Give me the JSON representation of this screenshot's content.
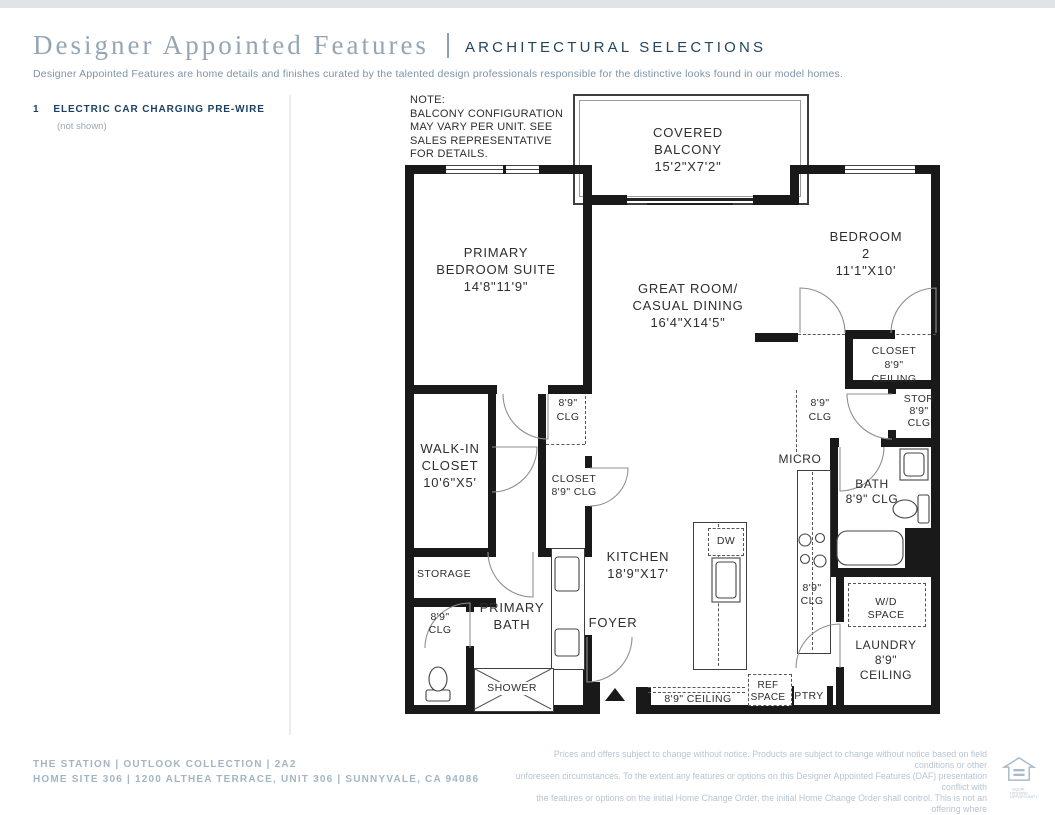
{
  "header": {
    "title": "Designer Appointed Features",
    "subtitle": "ARCHITECTURAL SELECTIONS",
    "description": "Designer Appointed Features are home details and finishes curated by the talented design professionals responsible for the distinctive looks found in our model homes."
  },
  "features": [
    {
      "num": "1",
      "label": "ELECTRIC CAR CHARGING PRE-WIRE",
      "note": "(not shown)"
    }
  ],
  "plan": {
    "note": [
      "NOTE:",
      "BALCONY CONFIGURATION",
      "MAY VARY PER UNIT. SEE",
      "SALES REPRESENTATIVE",
      "FOR DETAILS."
    ],
    "labels": [
      {
        "id": "covered-balcony",
        "lines": [
          "COVERED",
          "BALCONY",
          "15'2\"X7'2\""
        ]
      },
      {
        "id": "primary-bedroom-suite",
        "lines": [
          "PRIMARY",
          "BEDROOM SUITE",
          "14'8\"11'9\""
        ]
      },
      {
        "id": "great-room",
        "lines": [
          "GREAT ROOM/",
          "CASUAL DINING",
          "16'4\"X14'5\""
        ]
      },
      {
        "id": "bedroom-2",
        "lines": [
          "BEDROOM 2",
          "11'1\"X10'"
        ]
      },
      {
        "id": "bedroom2-closet",
        "lines": [
          "CLOSET",
          "8'9\" CEILING"
        ]
      },
      {
        "id": "hall2-clg",
        "lines": [
          "8'9\"",
          "CLG"
        ]
      },
      {
        "id": "stor",
        "lines": [
          "STOR",
          "8'9\"",
          "CLG"
        ]
      },
      {
        "id": "micro",
        "lines": [
          "MICRO"
        ]
      },
      {
        "id": "bath2",
        "lines": [
          "BATH",
          "8'9\" CLG"
        ]
      },
      {
        "id": "walk-in-closet",
        "lines": [
          "WALK-IN",
          "CLOSET",
          "10'6\"X5'"
        ]
      },
      {
        "id": "hall1-clg",
        "lines": [
          "8'9\"",
          "CLG"
        ]
      },
      {
        "id": "closet1",
        "lines": [
          "CLOSET",
          "8'9\" CLG"
        ]
      },
      {
        "id": "kitchen",
        "lines": [
          "KITCHEN",
          "18'9\"X17'"
        ]
      },
      {
        "id": "dw",
        "lines": [
          "DW"
        ]
      },
      {
        "id": "storage",
        "lines": [
          "STORAGE"
        ]
      },
      {
        "id": "primary-bath",
        "lines": [
          "PRIMARY",
          "BATH"
        ]
      },
      {
        "id": "toilet-clg",
        "lines": [
          "8'9\"",
          "CLG"
        ]
      },
      {
        "id": "foyer",
        "lines": [
          "FOYER"
        ]
      },
      {
        "id": "shower",
        "lines": [
          "SHOWER"
        ]
      },
      {
        "id": "range-clg",
        "lines": [
          "8'9\"",
          "CLG"
        ]
      },
      {
        "id": "wd-space",
        "lines": [
          "W/D SPACE"
        ]
      },
      {
        "id": "laundry",
        "lines": [
          "LAUNDRY",
          "8'9\" CEILING"
        ]
      },
      {
        "id": "kitchen-ceiling",
        "lines": [
          "8'9\" CEILING"
        ]
      },
      {
        "id": "ref-space",
        "lines": [
          "REF",
          "SPACE"
        ]
      },
      {
        "id": "ptry",
        "lines": [
          "PTRY"
        ]
      }
    ]
  },
  "footer": {
    "line1": "THE STATION | OUTLOOK COLLECTION | 2A2",
    "line2": "HOME SITE 306  |  1200 ALTHEA TERRACE, UNIT 306 | SUNNYVALE, CA 94086",
    "disclaimer": "Prices and offers subject to change without notice. Products are subject to change without notice based on field conditions or other\nunforeseen circumstances. To the extent any features or options on this Designer Appointed Features (DAF) presentation conflict with\nthe features or options on the initial Home Change Order, the initial Home Change Order shall control. This is not an offering where\nprohibited by law. Images are for representational purposes only and actual product may differ. Not all images may be shown. See online\nor onsite sales consultants for details.",
    "logo": [
      "EQUAL HOUSING",
      "OPPORTUNITY"
    ]
  },
  "colors": {
    "title_muted_blue": "#94a5b3",
    "accent_navy": "#24455f",
    "feature_navy": "#1c4163",
    "footer_blue_gray": "#a3b5c4",
    "fine_print": "#b6c5d3",
    "plan_line": "#191919",
    "top_band": "#e0e4e7"
  }
}
